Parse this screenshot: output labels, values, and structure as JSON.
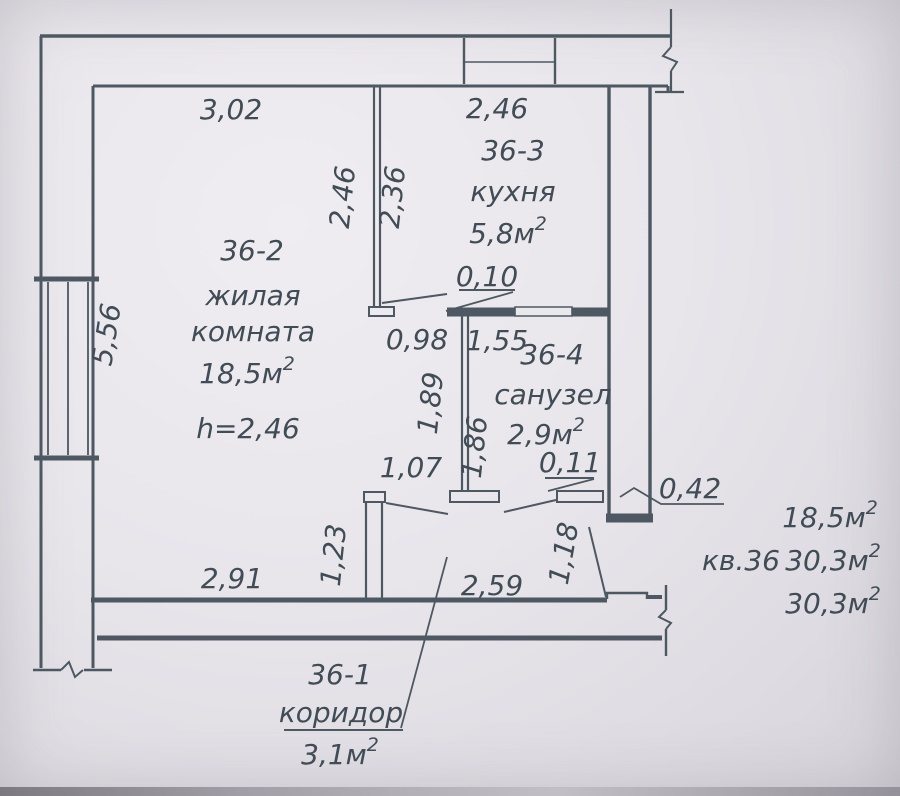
{
  "colors": {
    "paper": "#e9e7ec",
    "ink": "#4d5862",
    "text": "#414c56"
  },
  "rooms": {
    "living": {
      "number": "36-2",
      "name_line1": "жилая",
      "name_line2": "комната",
      "area": "18,5м",
      "area_sup": "2",
      "ceiling_height": "h=2,46"
    },
    "kitchen": {
      "number": "36-3",
      "name": "кухня",
      "area": "5,8м",
      "area_sup": "2"
    },
    "bathroom": {
      "number": "36-4",
      "name": "санузел",
      "area": "2,9м",
      "area_sup": "2"
    },
    "corridor": {
      "number": "36-1",
      "name": "коридор",
      "area": "3,1м",
      "area_sup": "2"
    }
  },
  "dimensions": {
    "living_width_top": "3,02",
    "kitchen_width_top": "2,46",
    "living_partition_height": "2,46",
    "kitchen_partition_height": "2,36",
    "living_height_left": "5,56",
    "kitchen_doorway": "0,10",
    "living_opening": "0,98",
    "bathroom_width_top": "1,55",
    "partition_length_living_side": "1,89",
    "bathroom_depth": "1,86",
    "living_doorway": "1,07",
    "bathroom_doorway": "0,11",
    "wall_thickness": "0,42",
    "living_width_bottom": "2,91",
    "door_partition": "1,23",
    "corridor_width": "2,59",
    "entrance_doorway": "1,18"
  },
  "summary": {
    "living_area": "18,5м",
    "living_area_sup": "2",
    "apartment": "кв.36",
    "total_area": "30,3м",
    "total_area_sup": "2",
    "total_area2": "30,3м",
    "total_area2_sup": "2"
  }
}
